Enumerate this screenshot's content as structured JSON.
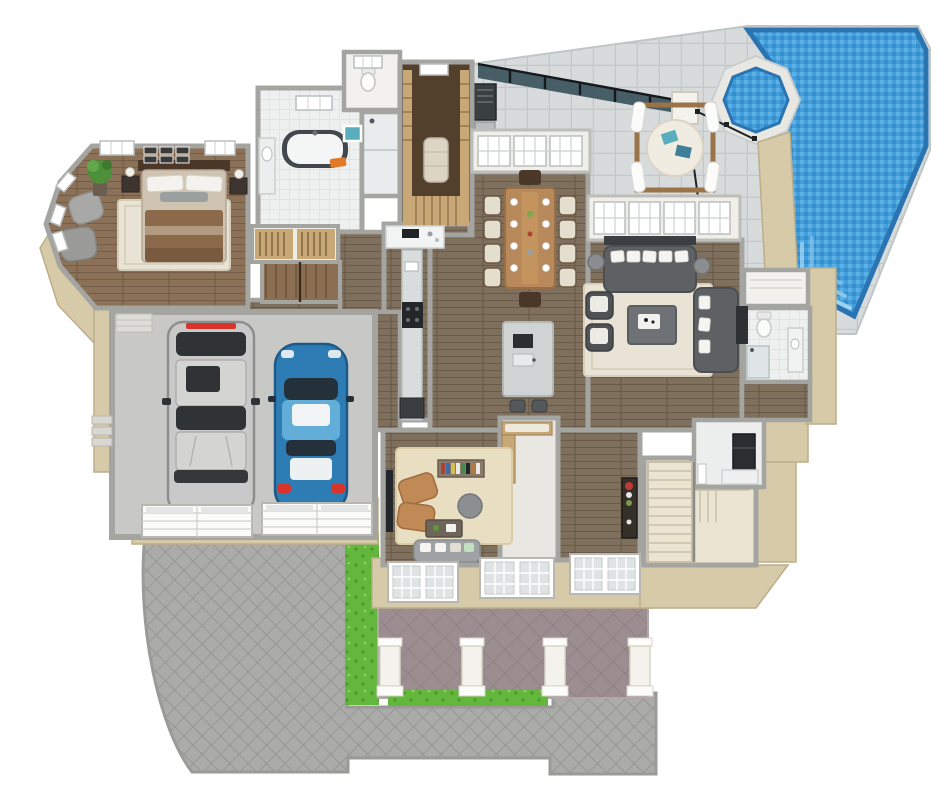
{
  "scene": {
    "kind": "3d-floor-plan-render",
    "areas": {
      "pool_terrace": {
        "label": "Pool terrace",
        "features": [
          "freeform-swimming-pool",
          "octagonal-spa",
          "glass-pool-fence",
          "stone-tile-deck",
          "pool-steps"
        ]
      },
      "lanai": {
        "label": "Covered lanai",
        "features": [
          "cabana-daybed-white-curtains",
          "teal-pillows",
          "outdoor-grill-station",
          "glass-screen-wall"
        ]
      },
      "great_room": {
        "label": "Great room",
        "furniture": [
          "sectional-sofa",
          "second-sofa",
          "accent-chairs-2",
          "coffee-table-with-tray",
          "cream-area-rug",
          "drum-table-lamps-2",
          "media-console"
        ]
      },
      "dining_room": {
        "label": "Dining room",
        "furniture": [
          "wood-dining-table",
          "upholstered-chairs-8",
          "host-chairs-2",
          "white-place-settings"
        ]
      },
      "kitchen": {
        "label": "Kitchen",
        "furniture": [
          "marble-island",
          "bar-stools-2",
          "black-range",
          "perimeter-counters",
          "butler-pantry-counter"
        ]
      },
      "master_bedroom": {
        "label": "Master bedroom",
        "furniture": [
          "king-bed-brown-bedding",
          "nightstands-2",
          "lamps-2",
          "armchairs-2",
          "potted-plant",
          "gallery-frames-6",
          "cream-rug"
        ]
      },
      "master_bathroom": {
        "label": "Master bathroom",
        "furniture": [
          "freestanding-tub",
          "orange-towel",
          "vanity-with-sink",
          "glass-shower",
          "teal-wall-art"
        ]
      },
      "walk_in_closet": {
        "label": "Walk-in closet",
        "furniture": [
          "wood-shelving",
          "ottoman-island",
          "shoe-shelves"
        ]
      },
      "hall": {
        "label": "Hallway",
        "features": [
          "twin-closets",
          "lower-stairwell"
        ]
      },
      "den": {
        "label": "Den",
        "furniture": [
          "tan-recliners-2",
          "bookcase",
          "round-pouf",
          "coffee-table",
          "gray-sofa",
          "wall-tv",
          "tan-rug"
        ]
      },
      "mudroom": {
        "label": "Mudroom",
        "furniture": [
          "built-in-bench"
        ]
      },
      "foyer": {
        "label": "Foyer",
        "furniture": [
          "console-table-with-flowers"
        ]
      },
      "stair_hall": {
        "label": "Stair hall",
        "features": [
          "l-shaped-staircase",
          "landing"
        ]
      },
      "laundry": {
        "label": "Laundry",
        "features": [
          "black-appliance",
          "marble-counter"
        ]
      },
      "pool_bath": {
        "label": "Pool bath",
        "features": [
          "toilet",
          "vanity-sink",
          "tiled-shower",
          "linen-closet"
        ]
      },
      "garage": {
        "label": "2-car garage",
        "vehicles": [
          "silver-suv",
          "blue-sports-car"
        ],
        "garage_doors": 2,
        "features": [
          "concrete-floor",
          "entry-steps"
        ]
      },
      "exterior": {
        "label": "Exterior",
        "features": [
          "diamond-paver-driveway",
          "paver-walkway",
          "lawn-strips",
          "front-porch-mauve-pavers",
          "porch-columns-4",
          "french-door-sets-3"
        ]
      }
    }
  },
  "colors": {
    "background": "#ffffff",
    "wall_gray": "#a4a4a1",
    "wall_light": "#f1efe9",
    "wall_tan": "#d7caa8",
    "wall_tan_dark": "#bcae8b",
    "floor_wood": "#7f6f5d",
    "floor_bedroom": "#8a7158",
    "floor_marble": "#eef0f0",
    "floor_concrete": "#c8c8c6",
    "deck_stone": "#d7dbdc",
    "deck_line": "#c3c8c9",
    "pool_water": "#41a0dc",
    "pool_border": "#2b74b2",
    "spa_coping": "#e9e7e1",
    "grass": "#63b73c",
    "porch_paver": "#9c8d91",
    "porch_line": "#887a7e",
    "drive_paver": "#ababa9",
    "drive_line": "#8f8f8d",
    "rug_cream": "#e8e3d4",
    "rug_tan": "#e8dec2",
    "sofa_gray": "#5d6164",
    "chair_cream": "#e4decf",
    "wood_table": "#b8895a",
    "wood_dark": "#4a3728",
    "closet_wood": "#c9a878",
    "tub_dark": "#41474c",
    "accent_teal": "#58aebd",
    "towel_orange": "#e07a28",
    "leather_tan": "#c08a56",
    "stairs_cream": "#ece4d2",
    "glass_dark": "#37505a",
    "car_silver": "#c9c9c9",
    "car_blue": "#2e7cb4",
    "car_blue_light": "#62aed8",
    "tail_red": "#d8342a"
  }
}
